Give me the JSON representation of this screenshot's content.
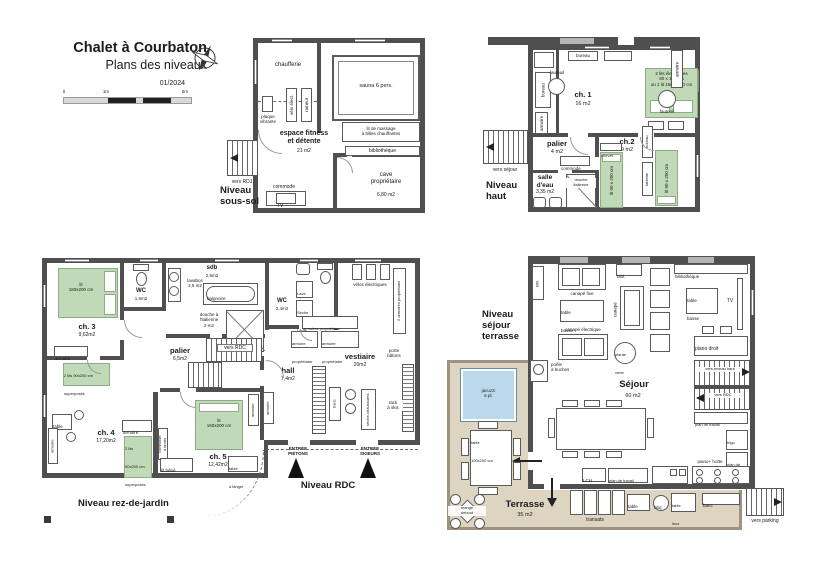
{
  "colors": {
    "wall": "#4f4f4f",
    "bed_green": "#c0d9b6",
    "terrace": "#ddd5c2",
    "jacuzzi": "#bcd9ec"
  },
  "title_block": {
    "title": "Chalet à Courbaton",
    "subtitle": "Plans des niveaux",
    "date": "01/2024",
    "scale_0": "0",
    "scale_1": "1m",
    "scale_5": "5m"
  },
  "sous_sol": {
    "level_label": "Niveau\nsous-sol",
    "stairs": "vers RDJ",
    "chaufferie": "chaufferie",
    "sauna": "sauna 6 pers.",
    "fitness": "espace fitness\net détente",
    "fitness_area": "21 m2",
    "massage": "lit de massage\nà billes chauffantes",
    "bibliotheque": "bibliothèque",
    "cave": "cave\npropriétaire",
    "cave_area": "6,80 m2",
    "commode": "commode",
    "tv": "TV",
    "velo": "vélo élect.",
    "rameur": "rameur",
    "plaque": "plaque\nvibrante"
  },
  "niveau_haut": {
    "level_label": "Niveau\nhaut",
    "stairs": "vers séjour",
    "ch1": "ch. 1",
    "ch1_area": "16 m2",
    "bureau_top": "bureau",
    "bureau_left": "bureau",
    "armoire_left": "armoire",
    "fauteuil_1": "fauteuil",
    "fauteuil_2": "fauteuil",
    "bed_ch1": "2 lits électriques\n80 x 190 cm\nou 1 lit 160 x 190 cm",
    "armoire_right": "armoire",
    "palier": "palier",
    "palier_area": "4 m2",
    "commode": "commode",
    "ch2": "ch.2",
    "ch2_area": "9 m2",
    "bed_left": "lit 90 x 200 cm",
    "bed_right": "lit 90 x 200 cm",
    "chevet": "chevet",
    "tablette": "tablette",
    "bureau_ch2": "bureau",
    "salle_eau": "salle\nd'eau",
    "salle_eau_area": "3,35 m2",
    "douche": "douche\nitalienne"
  },
  "rdj": {
    "level_label": "Niveau rez-de-jardin",
    "rdc_label": "Niveau RDC",
    "entree_pietons": "ENTRÉE\nPIÉTONS",
    "entree_skieurs": "ENTRÉE\nSKIEURS",
    "ch3": "ch. 3",
    "ch3_area": "9,62m2",
    "bed_ch3": "lit\n160x200 cm",
    "armoire_ch3": "armoire",
    "wc1": "WC",
    "wc1_area": "1,5m2",
    "sdb": "sdb",
    "sdb_area": "2,5m2",
    "lavabos": "lavabos\n2,5 m2",
    "baignoire": "baignoire",
    "douche": "douche à\nl'italienne\n2 m2",
    "wc2": "WC",
    "wc2_area": "2,4m2",
    "lave_linge": "Lave\nLinge",
    "seche_linge": "Sèche\nLinge",
    "palier": "palier",
    "palier_area": "6,5m2",
    "vers_rdc": "vers RDC",
    "hall": "hall",
    "hall_area": "7,4m2",
    "armoire_hall": "armoire",
    "vestiaire": "vestiaire",
    "vestiaire_area": "20m2",
    "velos": "vélos électriques",
    "armoires_prop": "armoires propriétaire",
    "armoire_prop": "armoire\npropriétaire",
    "banc": "banc",
    "seche_chaussures": "sèche-chaussures",
    "rack_skis": "rack\nà skis",
    "porte_batons": "porte\nbâtons",
    "armoires_skis": "2 armoires propriétaire",
    "ch4": "ch. 4",
    "ch4_area": "17,20m2",
    "bed_ch4a": "2 lits 90x200 cm\nsuperposés",
    "bed_ch4b": "2 lits\n90x200 cm\nsuperposés",
    "table_ch4": "table",
    "armoire_ch4a": "armoire",
    "armoire_ch4b": "armoire",
    "commode_tiroirs": "commode\nà tiroirs",
    "ch5": "ch. 5",
    "ch5_area": "12,42m2",
    "bed_ch5": "lit\n160x200 cm",
    "lit_bebe": "lit bébé",
    "table_langer": "table\nà langer",
    "armoire_ch5": "armoire"
  },
  "sejour": {
    "level_label": "Niveau\nséjour\nterrasse",
    "sejour": "Séjour",
    "sejour_area": "60 m2",
    "terrasse": "Terrasse",
    "terrasse_area": "35 m2",
    "jacuzzi": "jacuzzi\n6 pl.",
    "poele": "poêle\nà buches",
    "bibl_left": "bibl.",
    "bibl_top": "bibl.",
    "canape_fixe": "canapé fixe",
    "table_basse_1": "table\nbasse",
    "table_basse_2": "table\nbasse",
    "canape_elec": "canapé  électrique",
    "canape_v": "canapé",
    "bibliotheque": "bibliothèque",
    "tv": "TV",
    "piano_droit": "piano droit",
    "plante": "plante\nverte",
    "lch": "LCH",
    "plan_travail_1": "plan de travail",
    "plan_travail_2": "plan de travail",
    "plan_travail_3": "plan de\ntravail",
    "piano_hotte": "piano+ hotte",
    "frigo": "frigo",
    "vers_niveau_haut": "vers niveau haut",
    "vers_rdc": "vers RDC",
    "vers_parking": "vers parking",
    "table_terrasse": "table\n100x200 cm",
    "mange_debout": "mange\ndebout",
    "transats": "transats",
    "table_small": "table",
    "bbq": "bbq",
    "table_inox": "table\ninox",
    "banc": "banc"
  }
}
